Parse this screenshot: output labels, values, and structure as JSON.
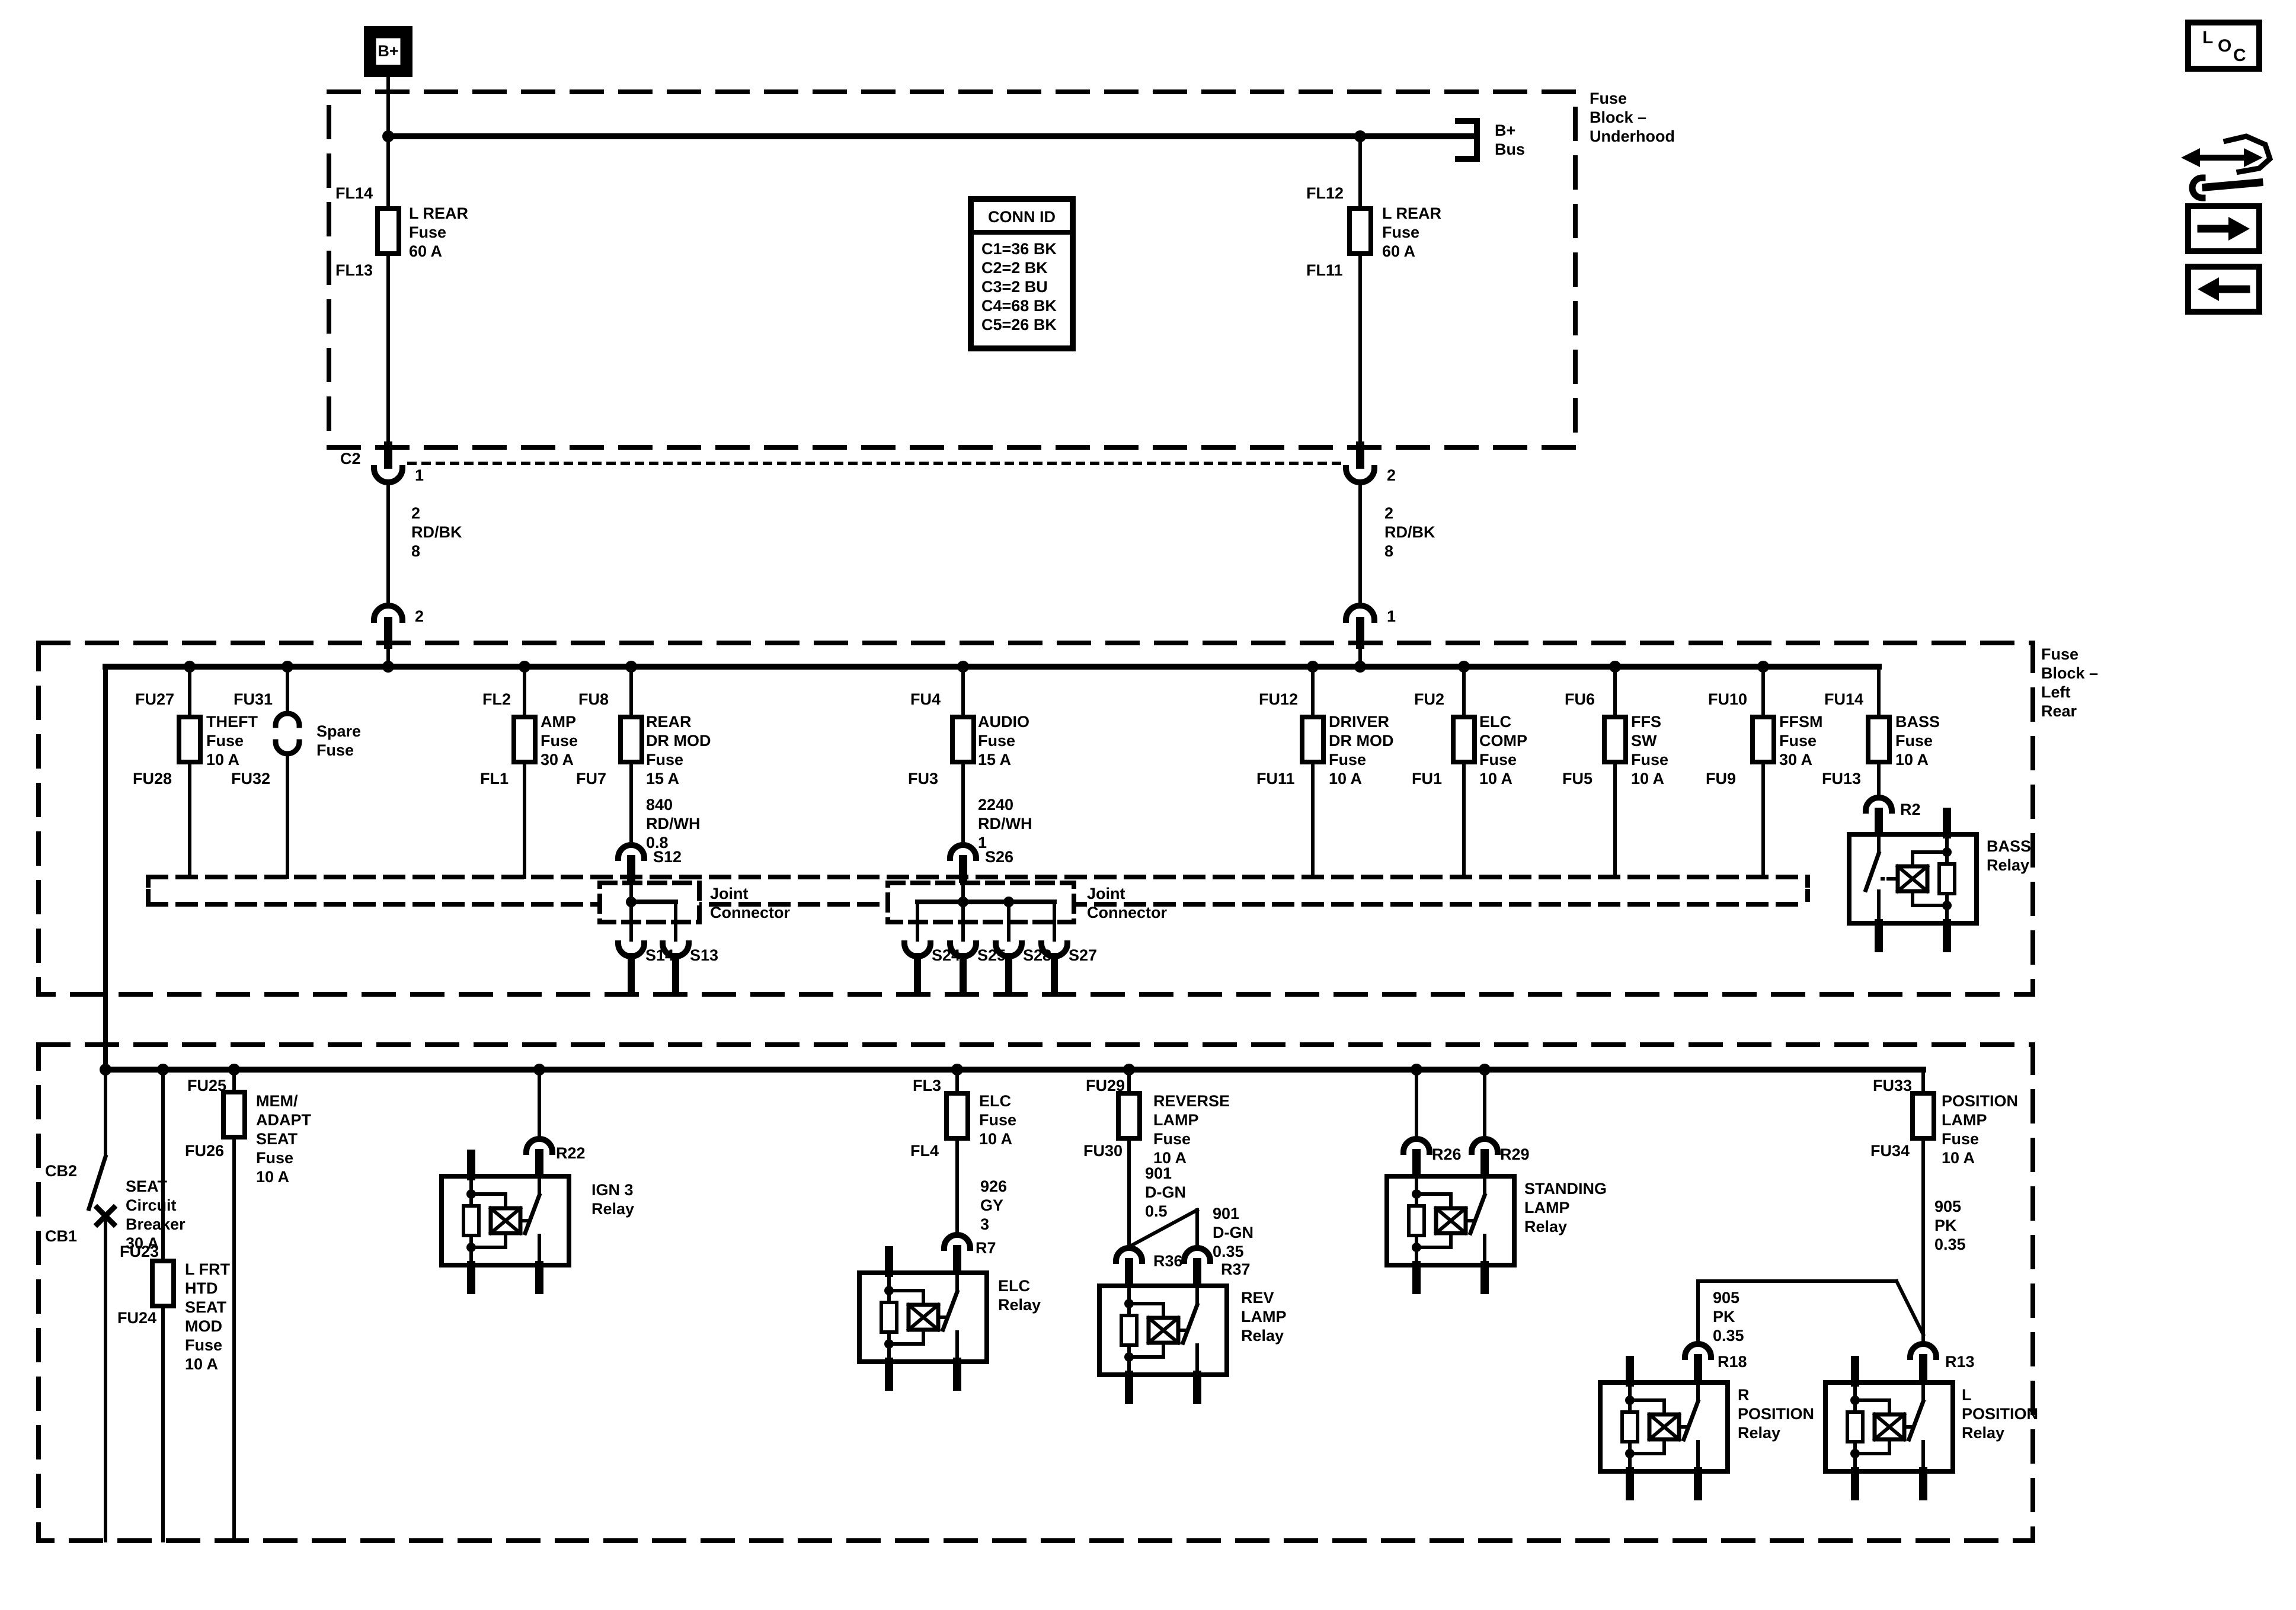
{
  "underhood": {
    "b_plus_terminal": "B+",
    "block_label": "Fuse\nBlock –\nUnderhood",
    "b_bus": "B+\nBus",
    "left": {
      "top": "FL14",
      "fuse": "L REAR\nFuse\n60 A",
      "bottom": "FL13"
    },
    "right": {
      "top": "FL12",
      "fuse": "L REAR\nFuse\n60 A",
      "bottom": "FL11"
    },
    "conn_id": {
      "title": "CONN ID",
      "rows": "C1=36 BK\nC2=2 BK\nC3=2 BU\nC4=68 BK\nC5=26 BK"
    }
  },
  "interconnect": {
    "c2": "C2",
    "left_pin_top": "1",
    "left_wire": "2\nRD/BK\n8",
    "left_pin_bottom": "2",
    "right_pin_top": "2",
    "right_wire": "2\nRD/BK\n8",
    "right_pin_bottom": "1"
  },
  "left_rear": {
    "block_label": "Fuse\nBlock –\nLeft\nRear",
    "theft": {
      "top": "FU27",
      "name": "THEFT\nFuse\n10 A",
      "bottom": "FU28"
    },
    "spare": {
      "top": "FU31",
      "name": "Spare\nFuse",
      "bottom": "FU32"
    },
    "amp": {
      "top": "FL2",
      "name": "AMP\nFuse\n30 A",
      "bottom": "FL1"
    },
    "rear_dr_mod": {
      "top": "FU8",
      "name": "REAR\nDR MOD\nFuse\n15 A",
      "bottom": "FU7",
      "wire": "840\nRD/WH\n0.8",
      "splice": "S12"
    },
    "audio": {
      "top": "FU4",
      "name": "AUDIO\nFuse\n15 A",
      "bottom": "FU3",
      "wire": "2240\nRD/WH\n1",
      "splice": "S26"
    },
    "joint1": {
      "label": "Joint\nConnector",
      "s14": "S14",
      "s13": "S13"
    },
    "joint2": {
      "label": "Joint\nConnector",
      "s24": "S24",
      "s25": "S25",
      "s28": "S28",
      "s27": "S27"
    },
    "driver": {
      "top": "FU12",
      "name": "DRIVER\nDR MOD\nFuse\n10 A",
      "bottom": "FU11"
    },
    "elc_comp": {
      "top": "FU2",
      "name": "ELC\nCOMP\nFuse\n10 A",
      "bottom": "FU1"
    },
    "ffs": {
      "top": "FU6",
      "name": "FFS\nSW\nFuse\n10 A",
      "bottom": "FU5"
    },
    "ffsm": {
      "top": "FU10",
      "name": "FFSM\nFuse\n30 A",
      "bottom": "FU9"
    },
    "bass": {
      "top": "FU14",
      "name": "BASS\nFuse\n10 A",
      "bottom": "FU13",
      "connector": "R2",
      "relay": "BASS\nRelay"
    }
  },
  "bottom": {
    "seat_cb": {
      "top": "CB2",
      "name": "SEAT\nCircuit\nBreaker\n30 A",
      "bottom": "CB1"
    },
    "l_frt": {
      "top": "FU23",
      "name": "L FRT\nHTD\nSEAT\nMOD\nFuse\n10 A",
      "bottom": "FU24"
    },
    "mem": {
      "top": "FU25",
      "name": "MEM/\nADAPT\nSEAT\nFuse\n10 A",
      "bottom": "FU26"
    },
    "ign3": {
      "connector": "R22",
      "relay": "IGN 3\nRelay"
    },
    "elc": {
      "top": "FL3",
      "name": "ELC\nFuse\n10 A",
      "bottom": "FL4",
      "wire": "926\nGY\n3",
      "connector": "R7",
      "relay": "ELC\nRelay"
    },
    "reverse": {
      "top": "FU29",
      "name": "REVERSE\nLAMP\nFuse\n10 A",
      "bottom": "FU30",
      "wire_main": "901\nD-GN\n0.5",
      "wire_branch": "901\nD-GN\n0.35",
      "connector_main": "R36",
      "connector_branch": "R37",
      "relay": "REV\nLAMP\nRelay"
    },
    "standing": {
      "connector_left": "R26",
      "connector_right": "R29",
      "relay": "STANDING\nLAMP\nRelay"
    },
    "position": {
      "top": "FU33",
      "name": "POSITION\nLAMP\nFuse\n10 A",
      "bottom": "FU34",
      "wire_main": "905\nPK\n0.35",
      "wire_branch": "905\nPK\n0.35",
      "connector_right": "R18",
      "connector_main": "R13",
      "relay_r": "R\nPOSITION\nRelay",
      "relay_l": "L\nPOSITION\nRelay"
    }
  },
  "toolbar": {
    "loc": [
      "L",
      "O",
      "C"
    ]
  },
  "colors": {
    "ink": "#000000",
    "paper": "#ffffff"
  }
}
